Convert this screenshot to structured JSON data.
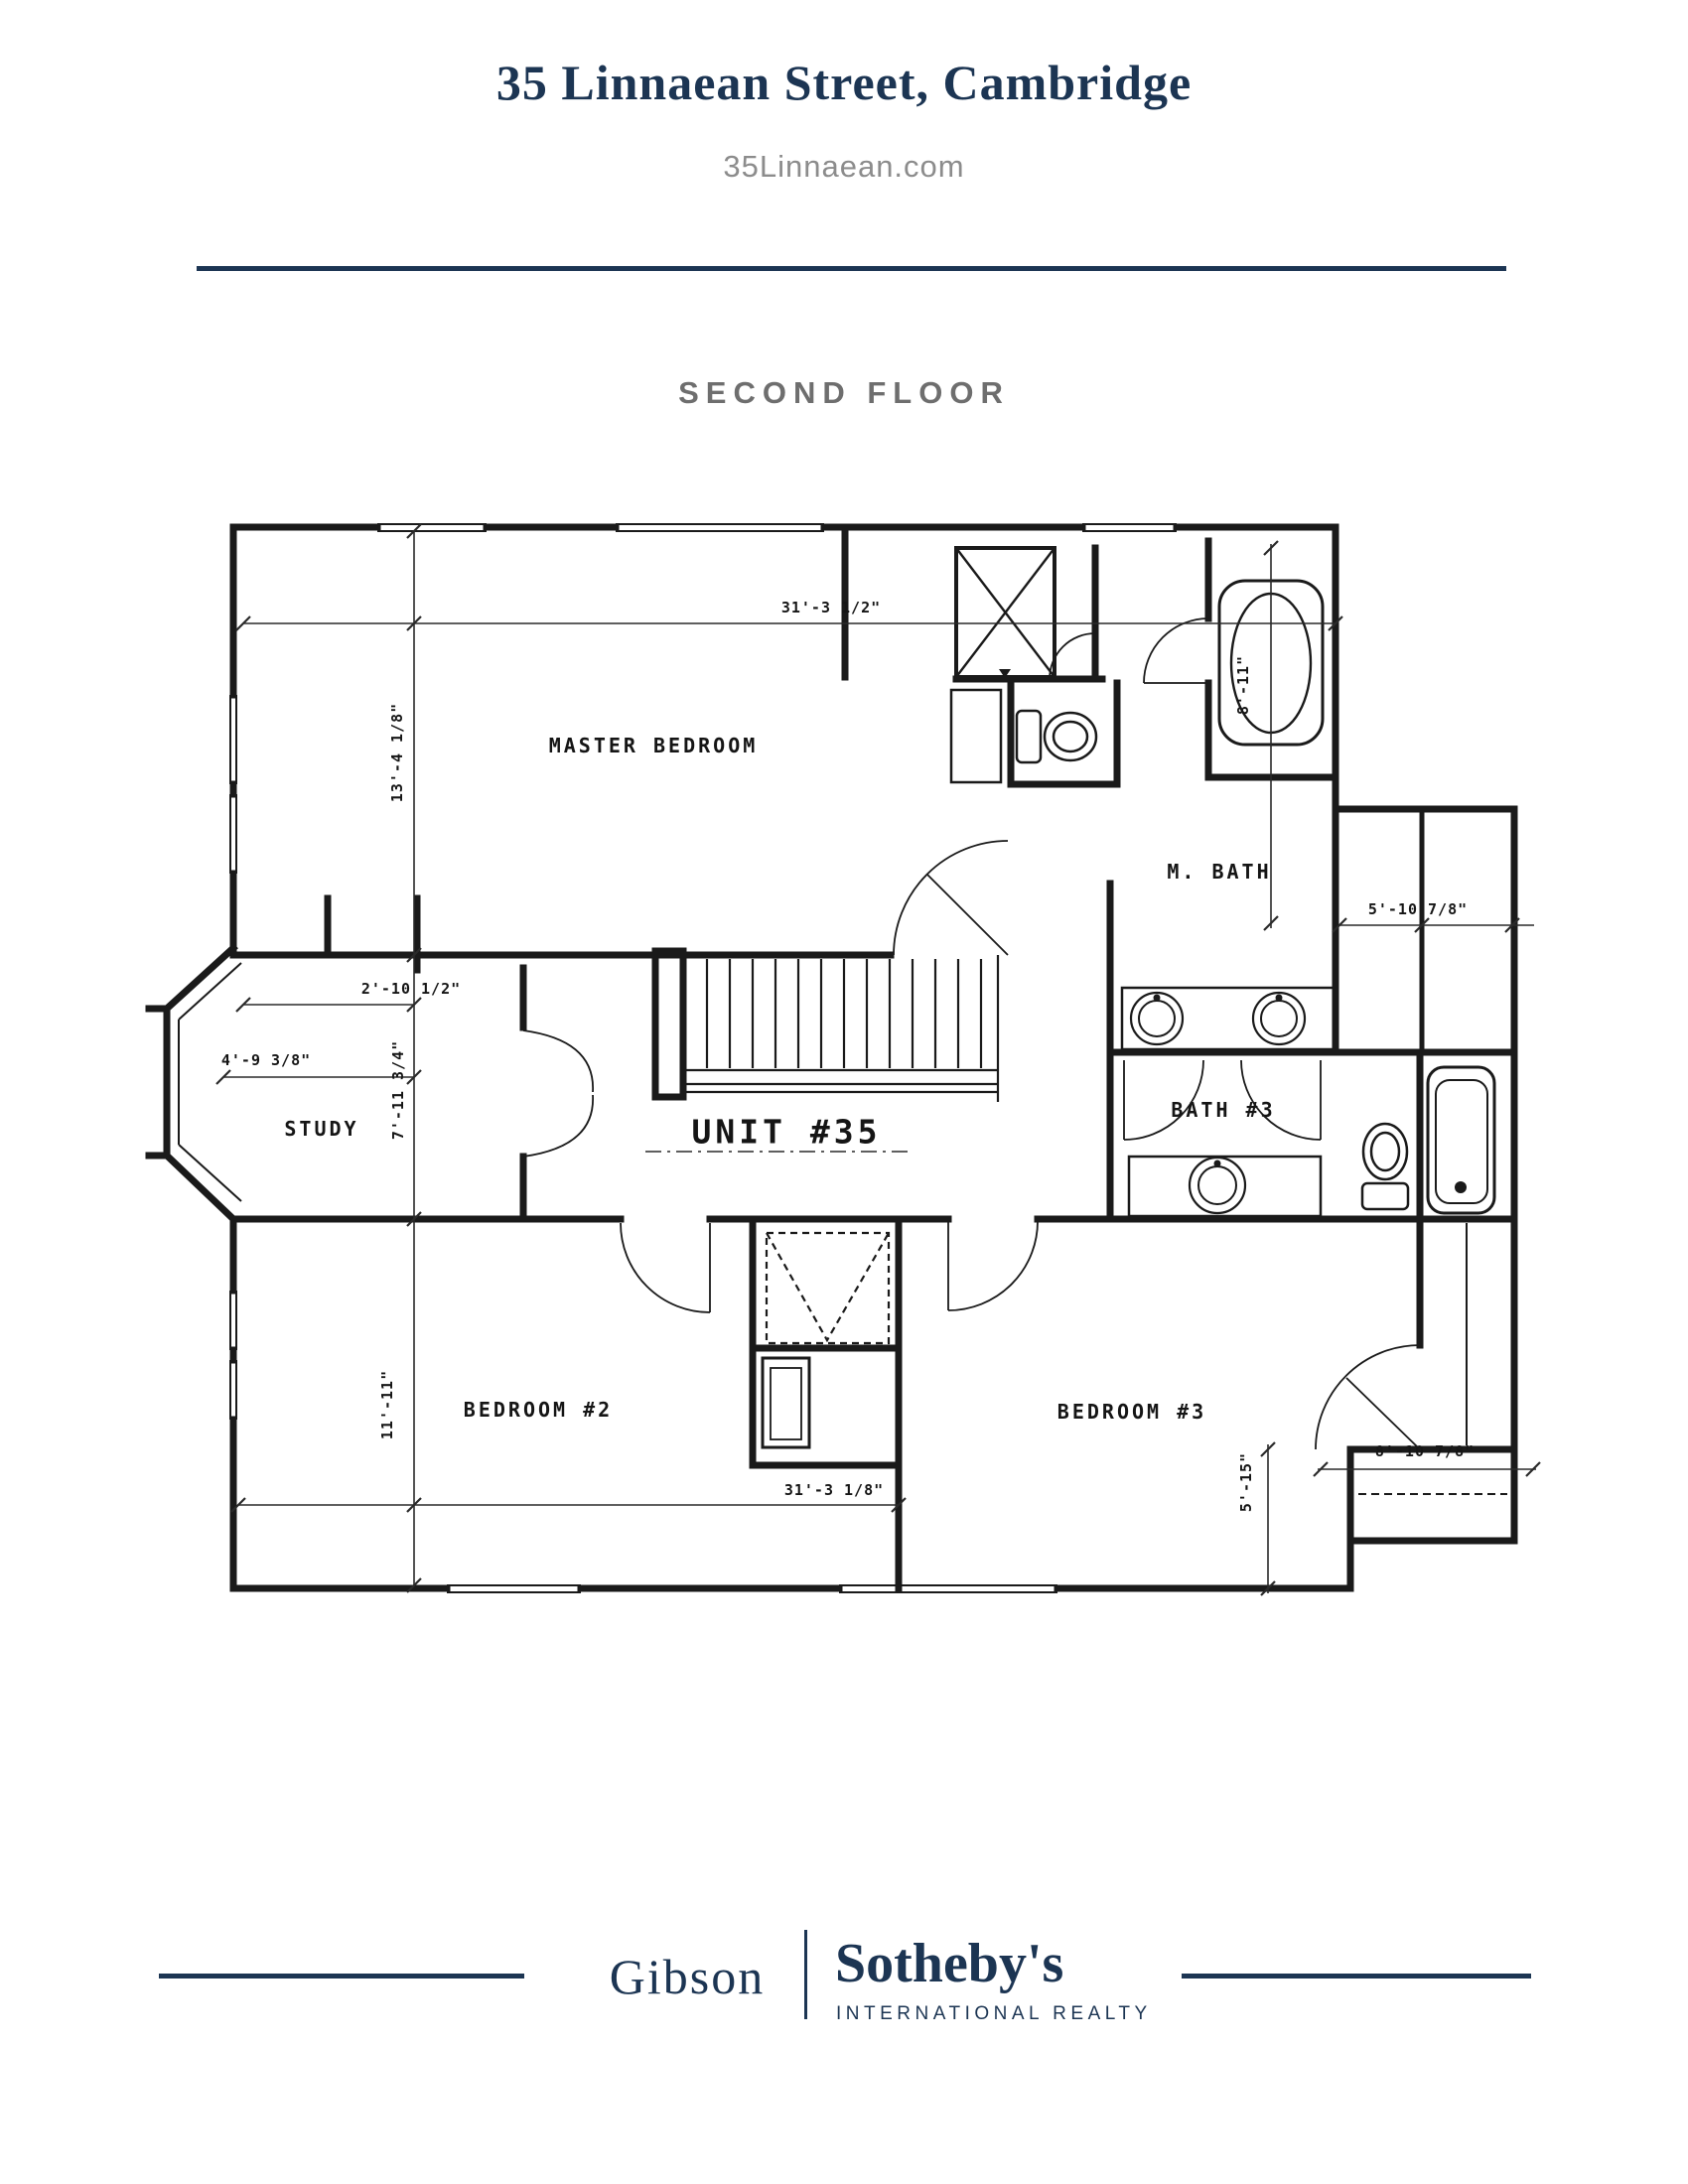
{
  "header": {
    "title": "35 Linnaean Street, Cambridge",
    "website": "35Linnaean.com"
  },
  "floor_label": "SECOND FLOOR",
  "plan": {
    "rooms": {
      "master_bedroom": "MASTER BEDROOM",
      "m_bath": "M. BATH",
      "study": "STUDY",
      "unit": "UNIT #35",
      "bath_3": "BATH #3",
      "bedroom_2": "BEDROOM #2",
      "bedroom_3": "BEDROOM #3"
    },
    "dims": {
      "top_width": "31'-3 1/2\"",
      "master_height": "13'-4 1/8\"",
      "study_offset": "2'-10 1/2\"",
      "study_width": "4'-9 3/8\"",
      "study_height": "7'-11 3/4\"",
      "bedroom2_height": "11'-11\"",
      "bottom_width": "31'-3 1/8\"",
      "closet_width": "5'-10 7/8\"",
      "tub_length": "8'-11\"",
      "b3_closet_width": "8'-10 7/8\"",
      "b3_right_height": "5'-15\""
    }
  },
  "footer": {
    "brand_primary": "Gibson",
    "brand_secondary": "Sotheby's",
    "brand_tagline": "INTERNATIONAL REALTY"
  },
  "colors": {
    "navy": "#1c3553",
    "subtitle_gray": "#8c8c8c",
    "floor_label_gray": "#6e6e6e",
    "plan_ink": "#1a1a1a"
  }
}
